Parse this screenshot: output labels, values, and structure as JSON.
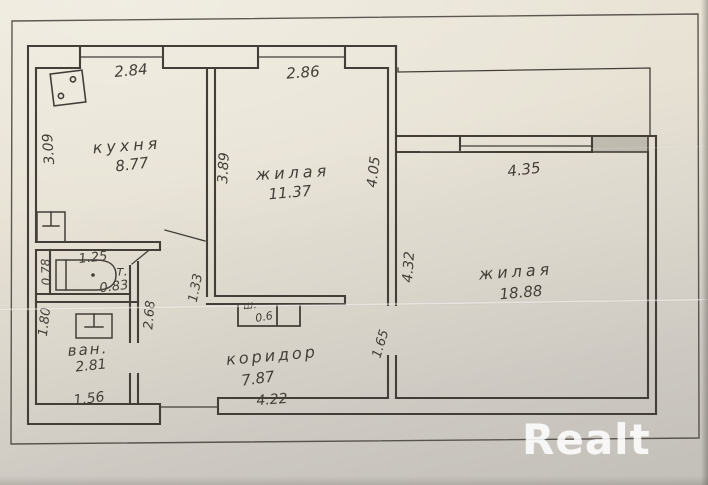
{
  "watermark": {
    "text": "Realt"
  },
  "colors": {
    "ink": "#433e38",
    "paper_light": "#ebe6d8",
    "paper_dark": "#c2beb8",
    "watermark": "rgba(255,255,255,0.80)"
  },
  "rooms": {
    "kitchen": {
      "name": "кухня",
      "area": "8.77"
    },
    "living1": {
      "name": "жилая",
      "area": "11.37"
    },
    "living2": {
      "name": "жилая",
      "area": "18.88"
    },
    "corridor": {
      "name": "коридор",
      "area": "7.87"
    },
    "bathroom": {
      "name": "ван.",
      "area": "2.81"
    },
    "toilet": {
      "name": "т.",
      "area": "0.83"
    },
    "closet": {
      "name": "ш.",
      "area": "0.6"
    }
  },
  "dimensions": {
    "kitchen_width": "2.84",
    "kitchen_depth": "3.09",
    "living1_width": "2.86",
    "living1_depth_left": "3.89",
    "living1_depth_right": "4.05",
    "living2_width": "4.35",
    "living2_depth": "4.32",
    "living2_wall_lower": "1.65",
    "corridor_length": "4.22",
    "hall_wall": "1.33",
    "bath_wall": "2.68",
    "bath_depth": "1.80",
    "bath_width": "1.56",
    "toilet_width": "1.25",
    "toilet_depth": "0.78"
  }
}
